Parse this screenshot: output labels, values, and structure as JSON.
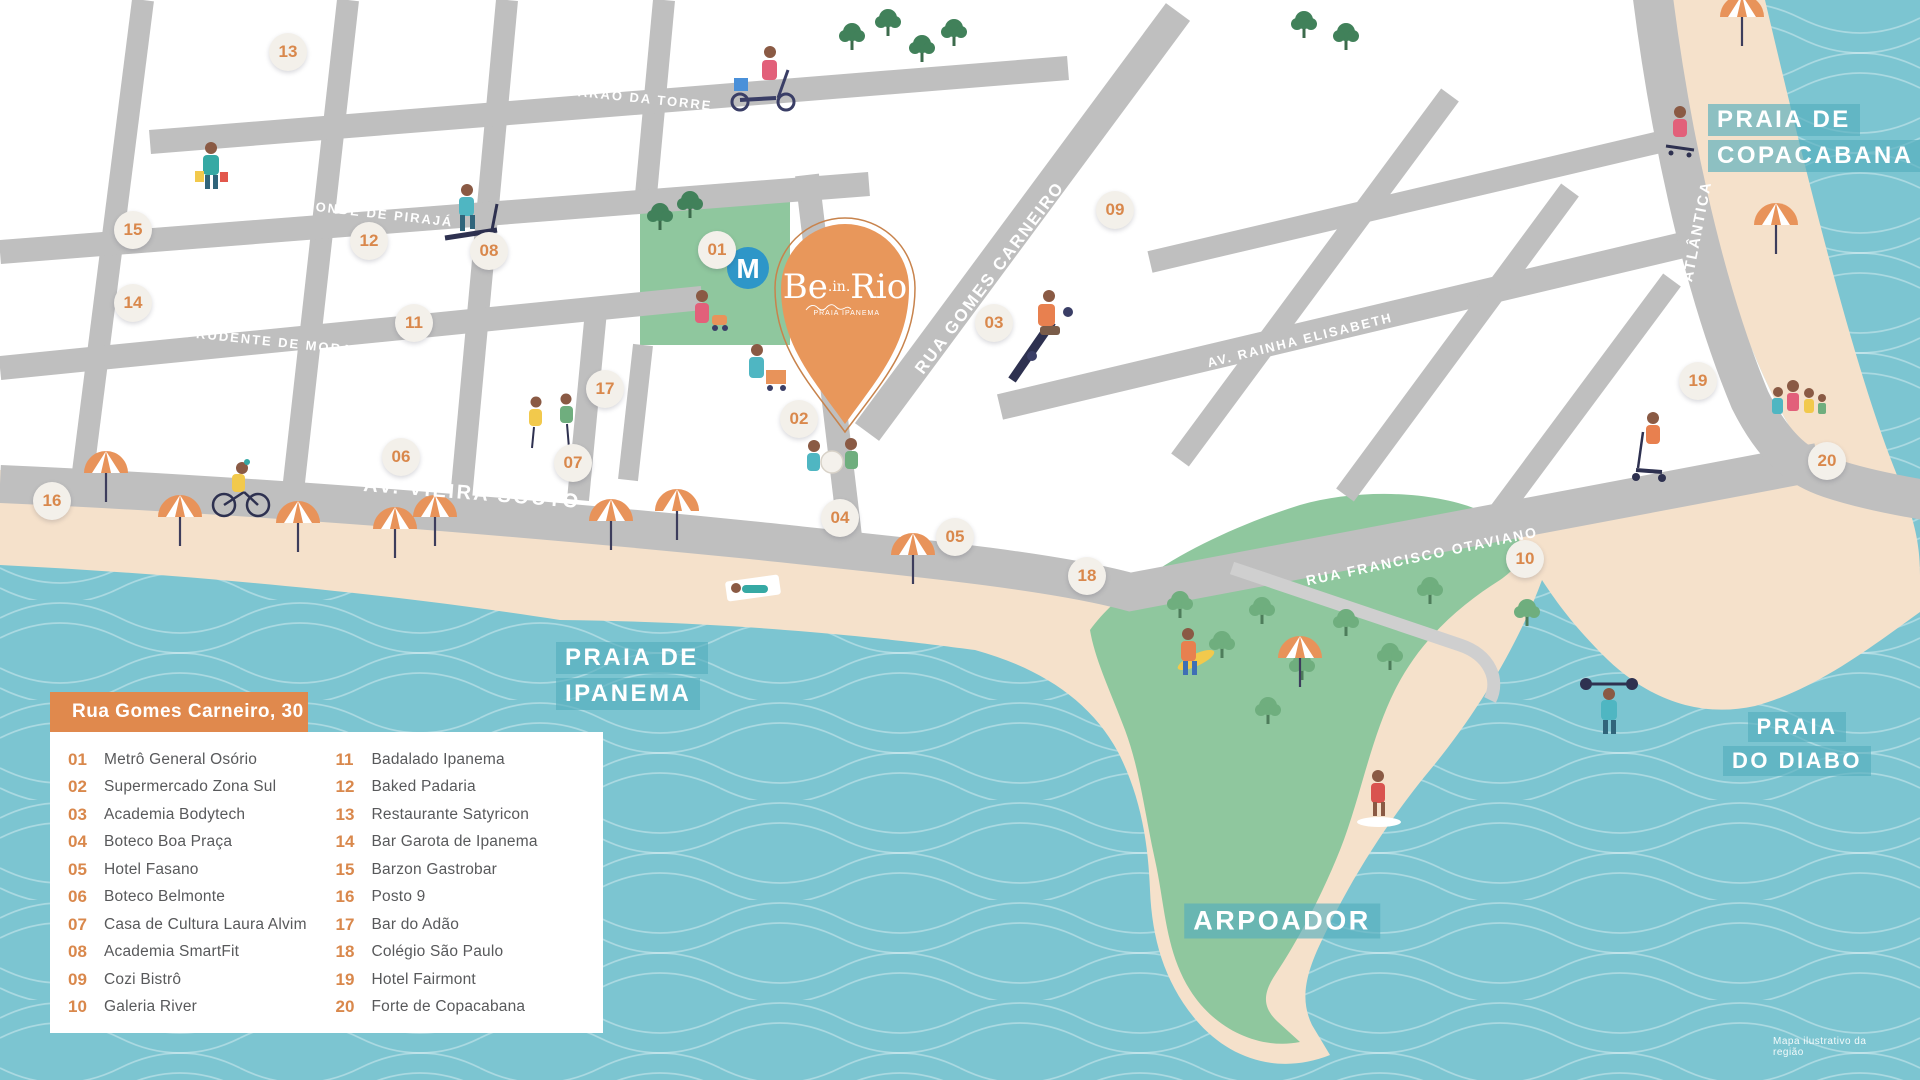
{
  "brand": {
    "name_be": "Be",
    "name_dot_in": ".in.",
    "name_rio": "Rio",
    "tagline": "PRAIA IPANEMA"
  },
  "metro": {
    "letter": "M"
  },
  "legend": {
    "title": "Rua Gomes Carneiro, 30",
    "items": [
      {
        "num": "01",
        "label": "Metrô General Osório"
      },
      {
        "num": "02",
        "label": "Supermercado Zona Sul"
      },
      {
        "num": "03",
        "label": "Academia Bodytech"
      },
      {
        "num": "04",
        "label": "Boteco Boa Praça"
      },
      {
        "num": "05",
        "label": "Hotel Fasano"
      },
      {
        "num": "06",
        "label": "Boteco Belmonte"
      },
      {
        "num": "07",
        "label": "Casa de Cultura Laura Alvim"
      },
      {
        "num": "08",
        "label": "Academia SmartFit"
      },
      {
        "num": "09",
        "label": "Cozi Bistrô"
      },
      {
        "num": "10",
        "label": "Galeria River"
      },
      {
        "num": "11",
        "label": "Badalado Ipanema"
      },
      {
        "num": "12",
        "label": "Baked Padaria"
      },
      {
        "num": "13",
        "label": "Restaurante Satyricon"
      },
      {
        "num": "14",
        "label": "Bar Garota de Ipanema"
      },
      {
        "num": "15",
        "label": "Barzon Gastrobar"
      },
      {
        "num": "16",
        "label": "Posto 9"
      },
      {
        "num": "17",
        "label": "Bar do Adão"
      },
      {
        "num": "18",
        "label": "Colégio São Paulo"
      },
      {
        "num": "19",
        "label": "Hotel Fairmont"
      },
      {
        "num": "20",
        "label": "Forte de Copacabana"
      }
    ]
  },
  "streets": {
    "barao": "RUA BARÃO DA TORRE",
    "visconde": "RUA VISCONDE DE PIRAJÁ",
    "prudente": "RUA PRUDENTE DE MORAIS",
    "vieira": "AV. VIEIRA SOUTO",
    "gomes": "RUA GOMES CARNEIRO",
    "rainha": "AV. RAINHA ELISABETH",
    "francisco": "RUA FRANCISCO OTAVIANO",
    "atlantica": "AV. ATLÂNTICA"
  },
  "places": {
    "ipanema_line1": "PRAIA DE",
    "ipanema_line2": "IPANEMA",
    "copacabana_line1": "PRAIA DE",
    "copacabana_line2": "COPACABANA",
    "diabo_line1": "PRAIA",
    "diabo_line2": "DO DIABO",
    "arpoador": "ARPOADOR"
  },
  "footnote": "Mapa ilustrativo da região",
  "colors": {
    "water": "#7CC5D1",
    "wave_line": "#FFFFFF",
    "sand": "#F5E1CB",
    "land": "#FFFFFF",
    "road": "#BFBFBF",
    "park_green": "#8FC79E",
    "tree_dark": "#41815A",
    "tree_light": "#6FAE7E",
    "pin_orange": "#E8975B",
    "accent_orange": "#E0894D",
    "marker_background": "#F3F0EA",
    "marker_number": "#D9884C",
    "legend_text": "#58595B",
    "metro_blue": "#2E96C8",
    "label_band": "#54AEBD"
  }
}
